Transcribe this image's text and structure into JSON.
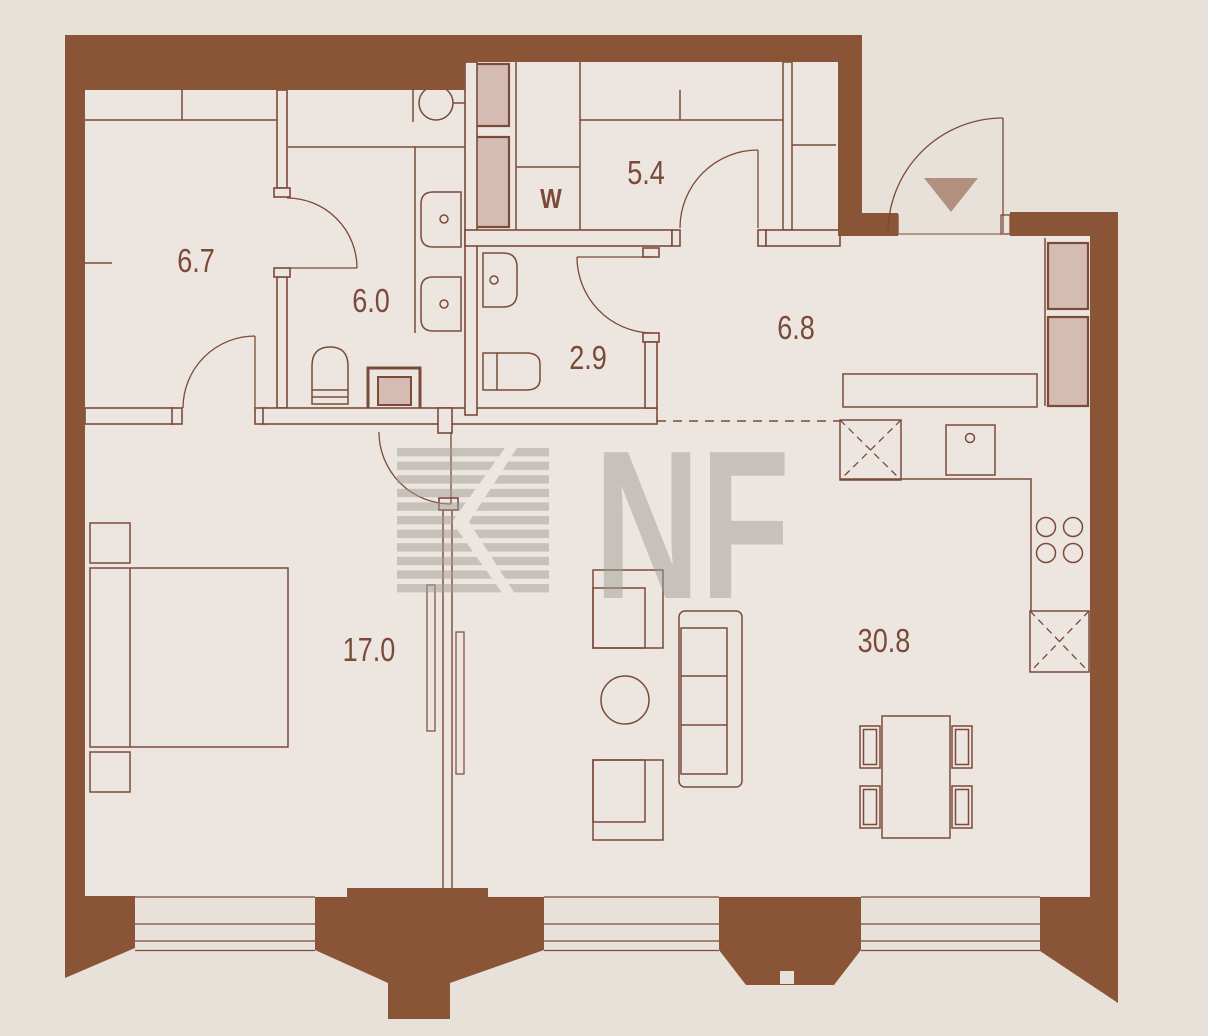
{
  "floorplan": {
    "watermark_text": "NF",
    "rooms": [
      {
        "name": "wardrobe-room",
        "area_label": "6.7"
      },
      {
        "name": "bathroom",
        "area_label": "6.0"
      },
      {
        "name": "laundry-room",
        "area_label": "5.4"
      },
      {
        "name": "washer-spot",
        "area_label": "W"
      },
      {
        "name": "wc",
        "area_label": "2.9"
      },
      {
        "name": "hallway",
        "area_label": "6.8"
      },
      {
        "name": "bedroom",
        "area_label": "17.0"
      },
      {
        "name": "living-kitchen",
        "area_label": "30.8"
      }
    ],
    "colors": {
      "background": "#e8e1da",
      "room_fill": "#ede6e0",
      "wall": "#8a5536",
      "line": "#7b4a38",
      "shaft_fill": "#d5bcb2",
      "entrance_marker": "#b2907f",
      "watermark": "#a39d97"
    }
  }
}
